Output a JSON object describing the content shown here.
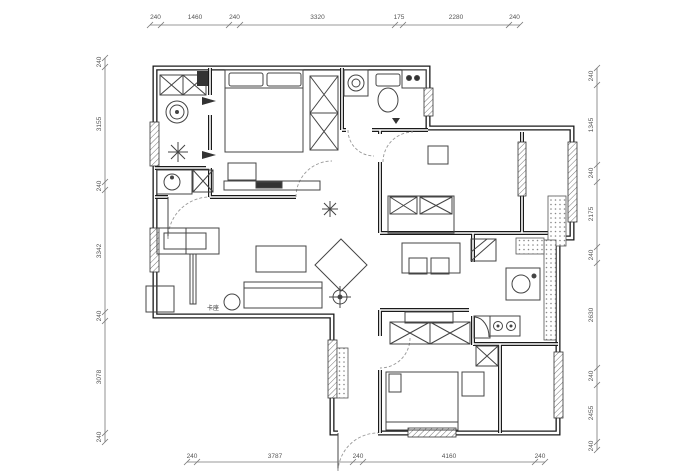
{
  "page": {
    "background": "#ffffff",
    "ink_color": "#1a1a1a",
    "dimension_text_color": "#555555"
  },
  "plan": {
    "type": "residential-floor-plan",
    "annotations": {
      "booth_seat": "卡座"
    },
    "dimensions_mm": {
      "top": [
        "240",
        "1460",
        "240",
        "3320",
        "175",
        "2280",
        "240"
      ],
      "bottom": [
        "240",
        "3787",
        "240",
        "4160",
        "240"
      ],
      "left": [
        "240",
        "3155",
        "240",
        "3342",
        "240",
        "3078",
        "240"
      ],
      "right": [
        "240",
        "1345",
        "240",
        "2175",
        "240",
        "2630",
        "240",
        "2455",
        "240"
      ]
    }
  }
}
